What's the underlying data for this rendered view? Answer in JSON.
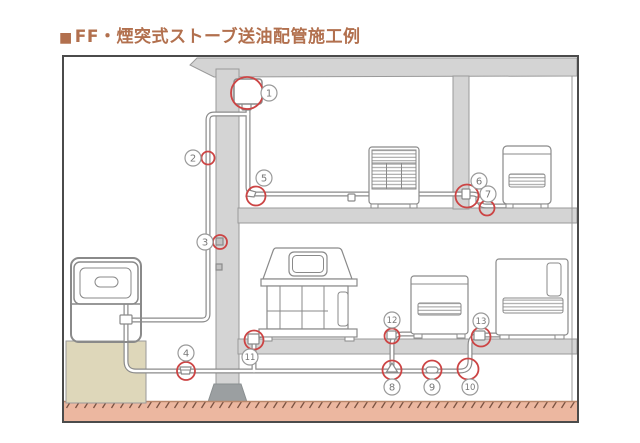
{
  "page": {
    "title_bullet": "■",
    "title": "FF・煙突式ストーブ送油配管施工例"
  },
  "colors": {
    "title_text": "#b2704e",
    "highlight_red": "#cc4444",
    "structure_gray": "#d4d4d4",
    "structure_outline": "#9a9a9a",
    "footing_gray": "#9b9fa1",
    "ground_salmon": "#ecb7a0",
    "foundation_beige": "#ded7ba",
    "pipe_outline": "#8a8a8a",
    "label_circle": "#999999",
    "label_text": "#777777"
  },
  "diagram": {
    "description_semantics": {
      "type": "piping-installation-cross-section",
      "building": "two-story house with outdoor oil tank, oil supply piping to four stoves",
      "marked_points_count": 13
    },
    "markers": [
      {
        "label": "1",
        "label_x": 205,
        "label_y": 36,
        "ring": {
          "shape": "circle",
          "cx": 183,
          "cy": 36,
          "r": 16
        }
      },
      {
        "label": "2",
        "label_x": 129,
        "label_y": 101,
        "ring": {
          "shape": "circle",
          "cx": 144,
          "cy": 101,
          "r": 6.5
        }
      },
      {
        "label": "3",
        "label_x": 141,
        "label_y": 185,
        "ring": {
          "shape": "circle",
          "cx": 156,
          "cy": 185,
          "r": 7
        }
      },
      {
        "label": "4",
        "label_x": 122,
        "label_y": 296,
        "ring": {
          "shape": "circle",
          "cx": 122,
          "cy": 314,
          "r": 9
        }
      },
      {
        "label": "5",
        "label_x": 200,
        "label_y": 121,
        "ring": {
          "shape": "circle",
          "cx": 192,
          "cy": 139,
          "r": 9.5
        }
      },
      {
        "label": "6",
        "label_x": 415,
        "label_y": 124,
        "ring": {
          "shape": "circle",
          "cx": 403,
          "cy": 139,
          "r": 11.5
        }
      },
      {
        "label": "7",
        "label_x": 424,
        "label_y": 137,
        "ring": {
          "shape": "circle",
          "cx": 423,
          "cy": 151,
          "r": 7.5
        }
      },
      {
        "label": "8",
        "label_x": 328,
        "label_y": 330,
        "ring": {
          "shape": "circle",
          "cx": 328,
          "cy": 313,
          "r": 9.5
        }
      },
      {
        "label": "9",
        "label_x": 368,
        "label_y": 330,
        "ring": {
          "shape": "circle",
          "cx": 368,
          "cy": 313,
          "r": 9.5
        }
      },
      {
        "label": "10",
        "label_x": 406,
        "label_y": 330,
        "ring": {
          "shape": "circle",
          "cx": 404,
          "cy": 312,
          "r": 10.5
        }
      },
      {
        "label": "11",
        "label_x": 186,
        "label_y": 300,
        "ring": {
          "shape": "circle",
          "cx": 190,
          "cy": 283,
          "r": 9.5
        }
      },
      {
        "label": "12",
        "label_x": 328,
        "label_y": 263,
        "ring": {
          "shape": "circle",
          "cx": 328,
          "cy": 279,
          "r": 7.5
        }
      },
      {
        "label": "13",
        "label_x": 417,
        "label_y": 264,
        "ring": {
          "shape": "circle",
          "cx": 417,
          "cy": 280,
          "r": 9.5
        }
      }
    ]
  }
}
